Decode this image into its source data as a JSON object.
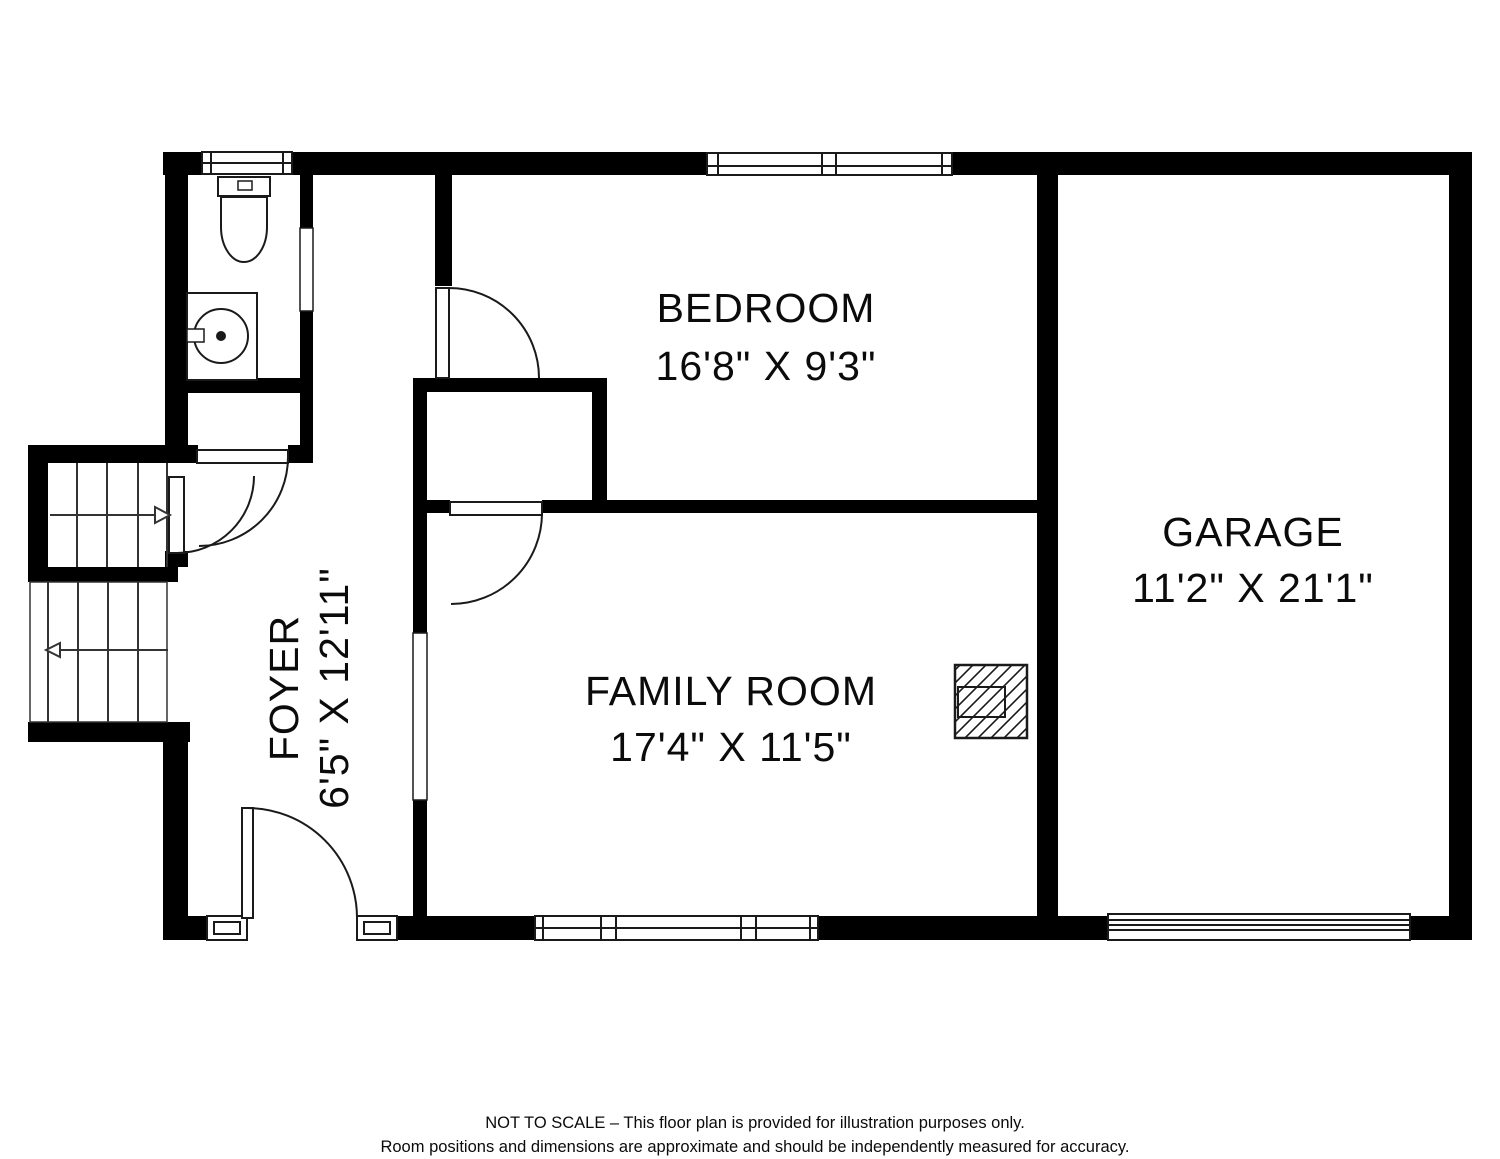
{
  "plan": {
    "rooms": [
      {
        "key": "bedroom",
        "name": "BEDROOM",
        "dimensions": "16'8\" X 9'3\""
      },
      {
        "key": "garage",
        "name": "GARAGE",
        "dimensions": "11'2\" X 21'1\""
      },
      {
        "key": "family-room",
        "name": "FAMILY ROOM",
        "dimensions": "17'4\" X 11'5\""
      },
      {
        "key": "foyer",
        "name": "FOYER",
        "dimensions": "6'5\" X 12'11\""
      }
    ],
    "fixtures": [
      "toilet",
      "sink-vanity",
      "staircase-up",
      "staircase-down",
      "fireplace",
      "entry-door",
      "garage-door"
    ],
    "disclaimer_line1": "NOT TO SCALE – This floor plan is provided for illustration purposes only.",
    "disclaimer_line2": "Room positions and dimensions are approximate and should be independently measured for accuracy.",
    "colors": {
      "wall": "#000000",
      "background": "#ffffff",
      "line": "#1a1a1a",
      "text": "#0b0b0b"
    }
  }
}
